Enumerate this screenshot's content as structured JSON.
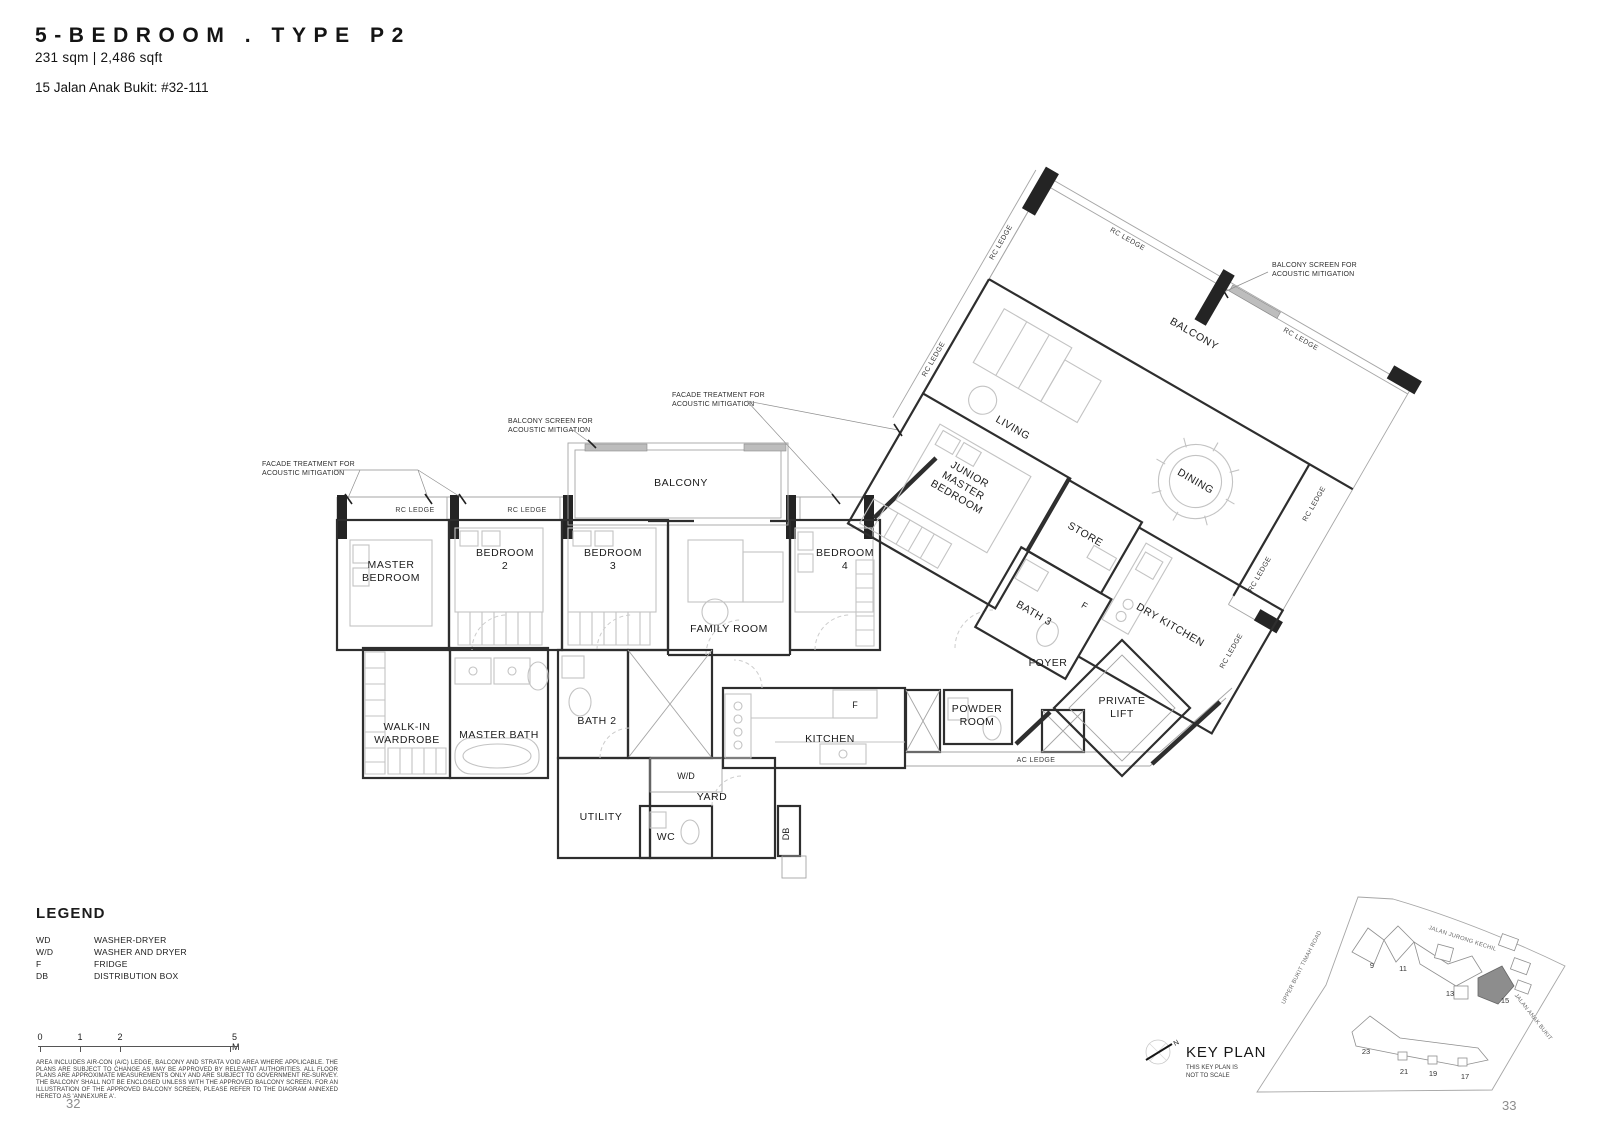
{
  "header": {
    "title": "5-BEDROOM . TYPE P2",
    "area": "231 sqm | 2,486 sqft",
    "address": "15 Jalan Anak Bukit: #32-111"
  },
  "plan": {
    "rooms": {
      "master_bedroom": [
        "MASTER",
        "BEDROOM"
      ],
      "bedroom2": [
        "BEDROOM",
        "2"
      ],
      "bedroom3": [
        "BEDROOM",
        "3"
      ],
      "bedroom4": [
        "BEDROOM",
        "4"
      ],
      "family_room": "FAMILY ROOM",
      "balcony_mid": "BALCONY",
      "balcony_main": "BALCONY",
      "junior_master": [
        "JUNIOR",
        "MASTER",
        "BEDROOM"
      ],
      "living": "LIVING",
      "dining": "DINING",
      "store": "STORE",
      "bath3": "BATH 3",
      "dry_kitchen": "DRY KITCHEN",
      "foyer": "FOYER",
      "private_lift": [
        "PRIVATE",
        "LIFT"
      ],
      "powder_room": [
        "POWDER",
        "ROOM"
      ],
      "kitchen": "KITCHEN",
      "bath2": "BATH 2",
      "master_bath": "MASTER BATH",
      "walk_in_wardrobe": [
        "WALK-IN",
        "WARDROBE"
      ],
      "utility": "UTILITY",
      "yard": "YARD",
      "wc": "WC"
    },
    "tags": {
      "wd": "W/D",
      "f": "F",
      "db": "DB"
    },
    "ledges": {
      "rc": "RC LEDGE",
      "ac": "AC LEDGE"
    },
    "annotations": {
      "facade": [
        "FACADE TREATMENT FOR",
        "ACOUSTIC MITIGATION"
      ],
      "balcony_screen": [
        "BALCONY SCREEN FOR",
        "ACOUSTIC MITIGATION"
      ]
    }
  },
  "legend": {
    "title": "LEGEND",
    "items": [
      {
        "abbr": "WD",
        "desc": "WASHER-DRYER"
      },
      {
        "abbr": "W/D",
        "desc": "WASHER AND DRYER"
      },
      {
        "abbr": "F",
        "desc": "FRIDGE"
      },
      {
        "abbr": "DB",
        "desc": "DISTRIBUTION BOX"
      }
    ]
  },
  "scalebar": {
    "ticks": [
      "0",
      "1",
      "2",
      "5 M"
    ]
  },
  "disclaimer": "AREA INCLUDES AIR-CON (A/C) LEDGE, BALCONY AND STRATA VOID AREA WHERE APPLICABLE. THE PLANS ARE SUBJECT TO CHANGE AS MAY BE APPROVED BY RELEVANT AUTHORITIES. ALL FLOOR PLANS ARE APPROXIMATE MEASUREMENTS ONLY AND ARE SUBJECT TO GOVERNMENT RE-SURVEY. THE BALCONY SHALL NOT BE ENCLOSED UNLESS WITH THE APPROVED BALCONY SCREEN. FOR AN ILLUSTRATION OF THE APPROVED BALCONY SCREEN, PLEASE REFER TO THE DIAGRAM ANNEXED HERETO AS 'ANNEXURE A'.",
  "keyplan": {
    "title": "KEY PLAN",
    "note": [
      "THIS KEY PLAN IS",
      "NOT TO SCALE"
    ],
    "north": "N",
    "roads": [
      "JALAN JURONG KECHIL",
      "UPPER BUKIT TIMAH ROAD",
      "JALAN ANAK BUKIT"
    ],
    "buildings": [
      "9",
      "11",
      "13",
      "15",
      "17",
      "19",
      "21",
      "23"
    ],
    "highlighted_building": "15"
  },
  "pages": {
    "left": "32",
    "right": "33"
  }
}
